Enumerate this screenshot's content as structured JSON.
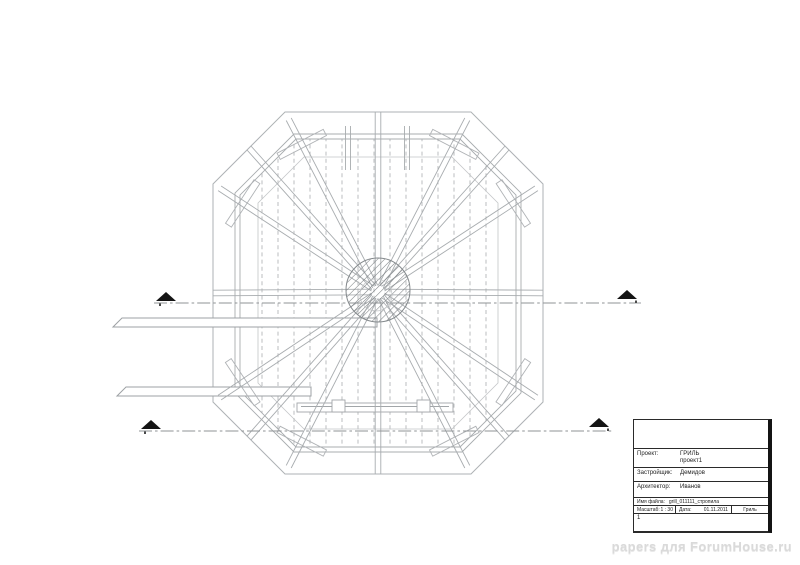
{
  "page": {
    "background": "#ffffff"
  },
  "drawing": {
    "kind": "octagonal grill-house roof rafter plan, top view",
    "center_feature": "hatched circular chimney opening",
    "rafter_count": 16,
    "line_color": "#a8acaf",
    "section_marker_color": "#141414",
    "section_lines": 2
  },
  "title_block": {
    "project_label": "Проект:",
    "project_value": "ГРИЛЬ",
    "project_value2": "проект1",
    "client_label": "Застройщик:",
    "client_value": "Демидов",
    "architect_label": "Архитектор:",
    "architect_value": "Иванов",
    "file_label": "Имя файла:",
    "file_value": "grill_011111_стропила",
    "scale_label": "Масштаб:",
    "scale_value": "1 : 30",
    "date_label": "Дата:",
    "date_value": "01.11.2011",
    "sheet_name": "Гриль",
    "sheet_number": "1"
  },
  "watermark": {
    "text": "papers для ForumHouse.ru",
    "color": "#d9d9d9"
  }
}
